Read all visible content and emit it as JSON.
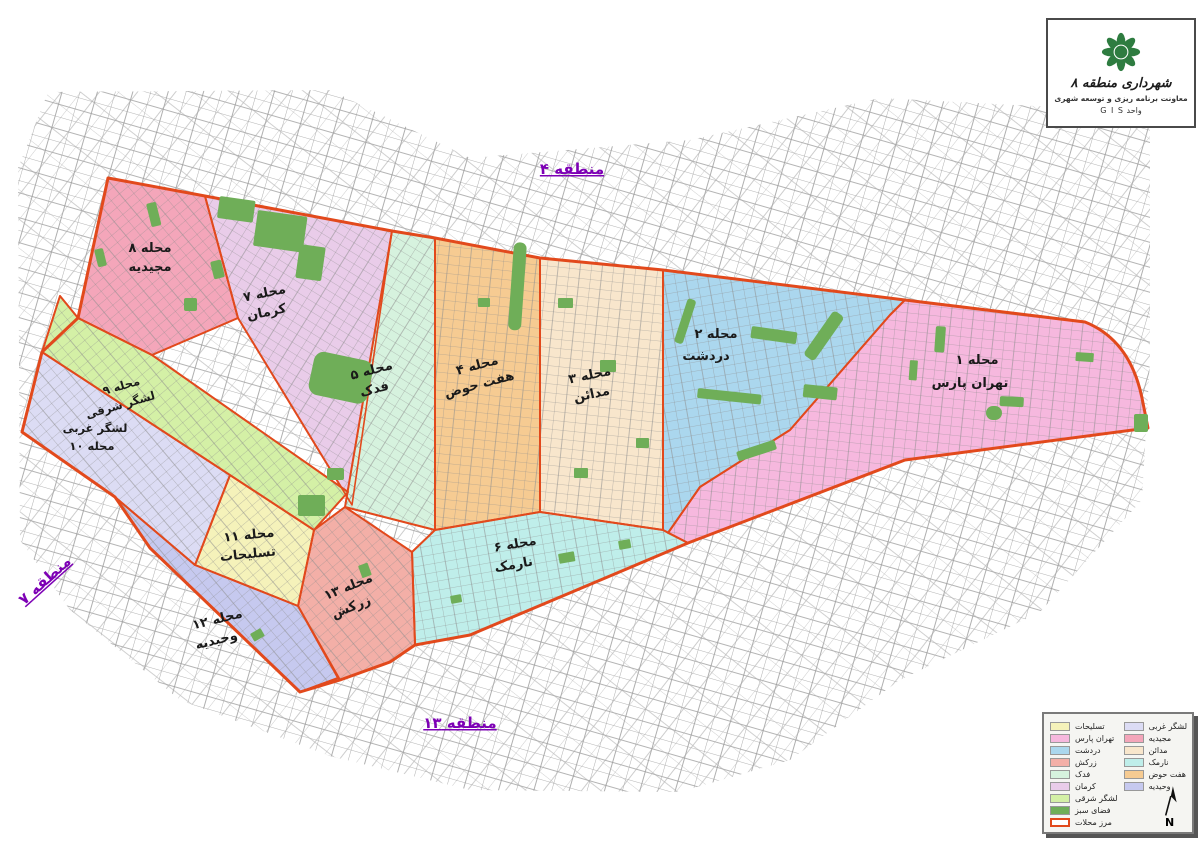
{
  "title_box": {
    "title": "شهرداری منطقه ۸",
    "subtitle": "معاونت برنامه ریزی و توسعه شهری",
    "unit_label": "واحد G I S",
    "logo_color": "#2e7c40",
    "logo_name": "tehran-municipality-logo"
  },
  "adjacent_districts": {
    "top": "منطقه ۴",
    "left": "منطقه ۷",
    "bottom": "منطقه ۱۳",
    "label_color": "#7d00b5"
  },
  "regions": {
    "tehranpars": {
      "id_label": "محله ۱",
      "name": "تهران پارس",
      "color": "#f6b8de"
    },
    "dardasht": {
      "id_label": "محله ۲",
      "name": "دردشت",
      "color": "#abd7ee"
    },
    "madaen": {
      "id_label": "محله ۳",
      "name": "مدائن",
      "color": "#f8e6cc"
    },
    "haft_howz": {
      "id_label": "محله ۴",
      "name": "هفت حوض",
      "color": "#f6cb92"
    },
    "fadak": {
      "id_label": "محله ۵",
      "name": "فدک",
      "color": "#d6f2de"
    },
    "narmak": {
      "id_label": "محله ۶",
      "name": "نارمک",
      "color": "#bfeeea"
    },
    "kerman": {
      "id_label": "محله ۷",
      "name": "کرمان",
      "color": "#e9cce9"
    },
    "majidieh": {
      "id_label": "محله ۸",
      "name": "مجیدیه",
      "color": "#f4a6ba"
    },
    "lashgar_sharghi": {
      "id_label": "محله ۹",
      "name": "لشگر شرقی",
      "color": "#d4f0a6"
    },
    "lashgar_gharbi": {
      "id_label": "محله ۱۰",
      "name": "لشگر غربی",
      "color": "#dcdcf4"
    },
    "taslihat": {
      "id_label": "محله ۱۱",
      "name": "تسلیحات",
      "color": "#f5f2ba"
    },
    "vahidieh": {
      "id_label": "محله ۱۲",
      "name": "وحیدیه",
      "color": "#c6c9ef"
    },
    "zarkesh": {
      "id_label": "محله ۱۳",
      "name": "زرکش",
      "color": "#f3afa7"
    }
  },
  "legend": {
    "left": [
      {
        "label": "تسلیحات",
        "color": "#f5f2ba"
      },
      {
        "label": "تهران پارس",
        "color": "#f6b8de"
      },
      {
        "label": "دردشت",
        "color": "#abd7ee"
      },
      {
        "label": "زرکش",
        "color": "#f3afa7"
      },
      {
        "label": "فدک",
        "color": "#d6f2de"
      },
      {
        "label": "کرمان",
        "color": "#e9cce9"
      },
      {
        "label": "لشگر شرقی",
        "color": "#d4f0a6"
      }
    ],
    "right": [
      {
        "label": "لشگر غربی",
        "color": "#dcdcf4"
      },
      {
        "label": "مجیدیه",
        "color": "#f4a6ba"
      },
      {
        "label": "مدائن",
        "color": "#f8e6cc"
      },
      {
        "label": "نارمک",
        "color": "#bfeeea"
      },
      {
        "label": "هفت حوض",
        "color": "#f6cb92"
      },
      {
        "label": "وحیدیه",
        "color": "#c6c9ef"
      }
    ],
    "green_space": {
      "label": "فضای سبز",
      "color": "#6fae58"
    },
    "boundary": {
      "label": "مرز محلات",
      "color": "#e2491c"
    },
    "north_label": "N"
  }
}
